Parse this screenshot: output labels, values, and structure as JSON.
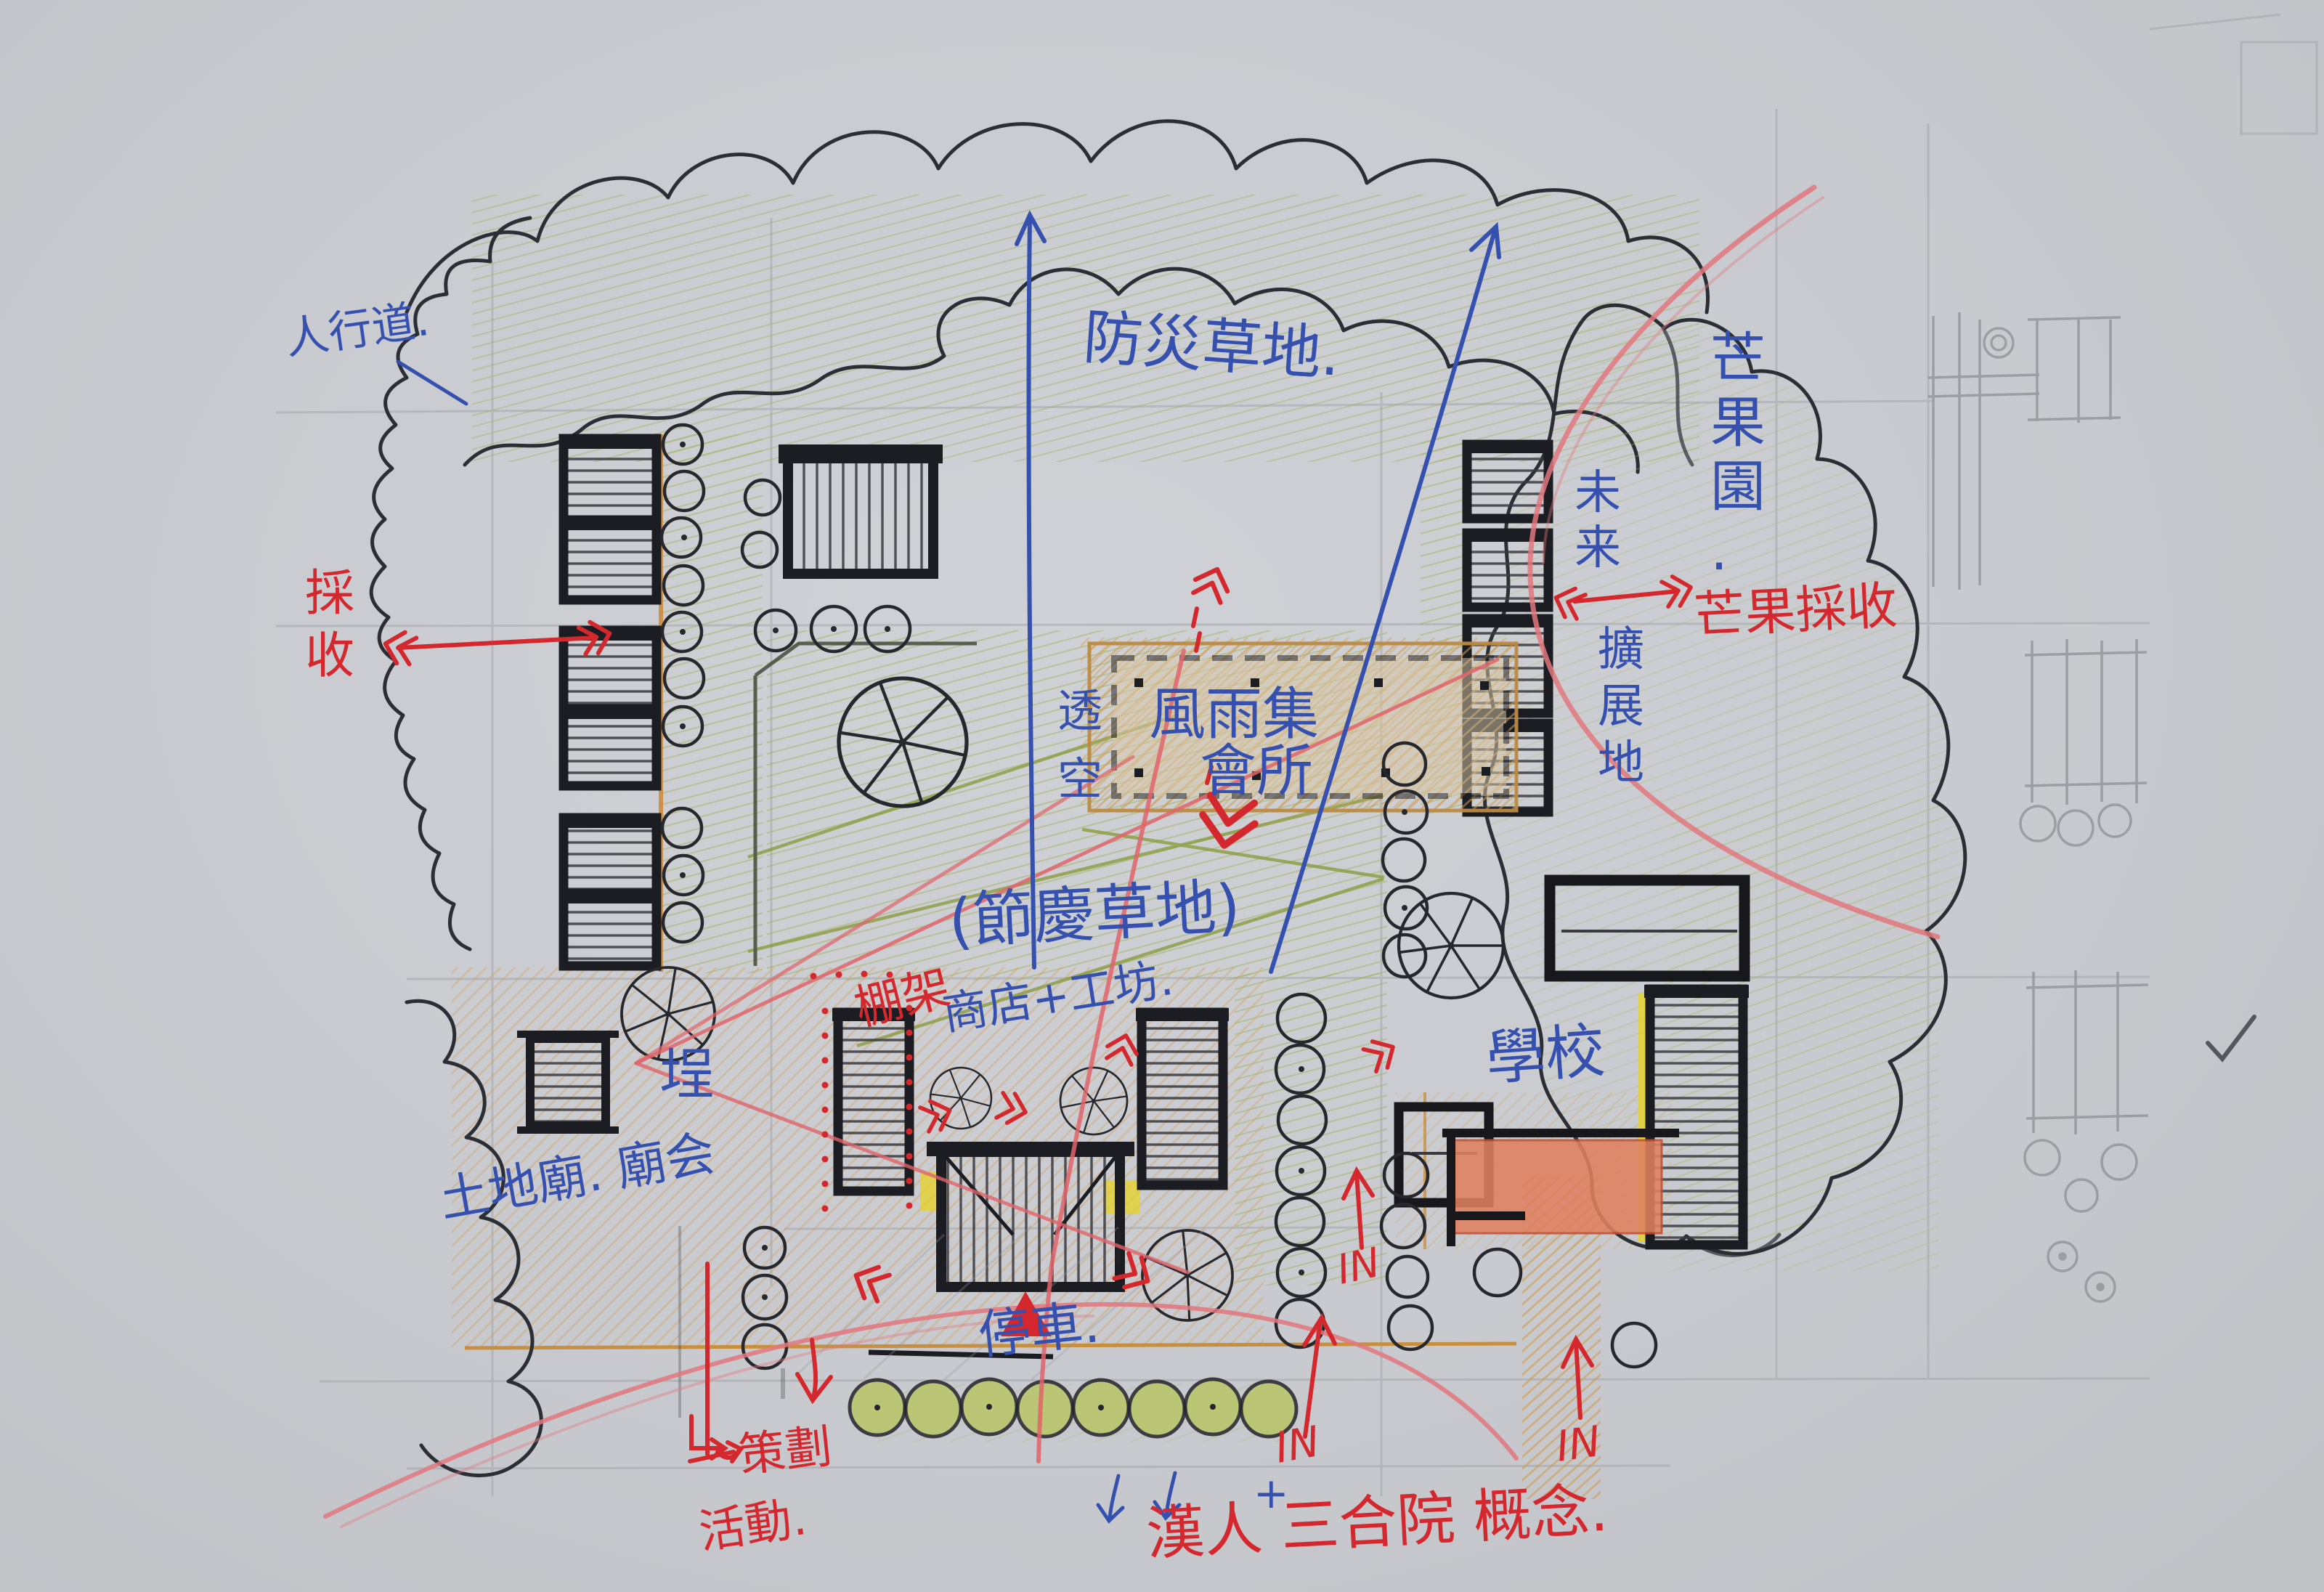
{
  "title": "hand-drawn community site plan concept sketch",
  "labels": {
    "sidewalk": "人行道.",
    "disaster_lawn": "防災草地.",
    "harvest_left": "採收",
    "mango_orchard": "芒果園.",
    "future": "未来",
    "expansion": "擴展地",
    "mango_harvest": "芒果採收",
    "open_through": "透空",
    "hall_line1": "風雨集",
    "hall_line2": "會所",
    "festival_lawn": "(節慶草地)",
    "pergola": "棚架",
    "shop_workshop": "商店+工坊.",
    "school": "學校",
    "courtyard": "埕",
    "earth_temple": "土地廟. 廟会",
    "parking": "停車.",
    "plan_line1": "策劃",
    "plan_line2": "活動.",
    "han_concept": "漢人 三合院 概念.",
    "in_mid": "IN",
    "in_left": "IN",
    "in_right": "IN",
    "plus_mark": "+"
  },
  "colors": {
    "paper": "#c9cbd0",
    "ink_black": "#1c1d22",
    "pen_blue": "#3550ae",
    "pen_red": "#d4282e",
    "pencil_red": "#e0646b",
    "pencil_pink": "#e2777e",
    "pencil_green": "#9fb45c",
    "pencil_olive": "#8d9c3f",
    "pencil_tan": "#d2a258",
    "pencil_orange": "#cf8b3a",
    "fill_salmon": "#df8160",
    "highlight_yellow": "#e6d22e",
    "pencil_gray": "#94969c"
  }
}
